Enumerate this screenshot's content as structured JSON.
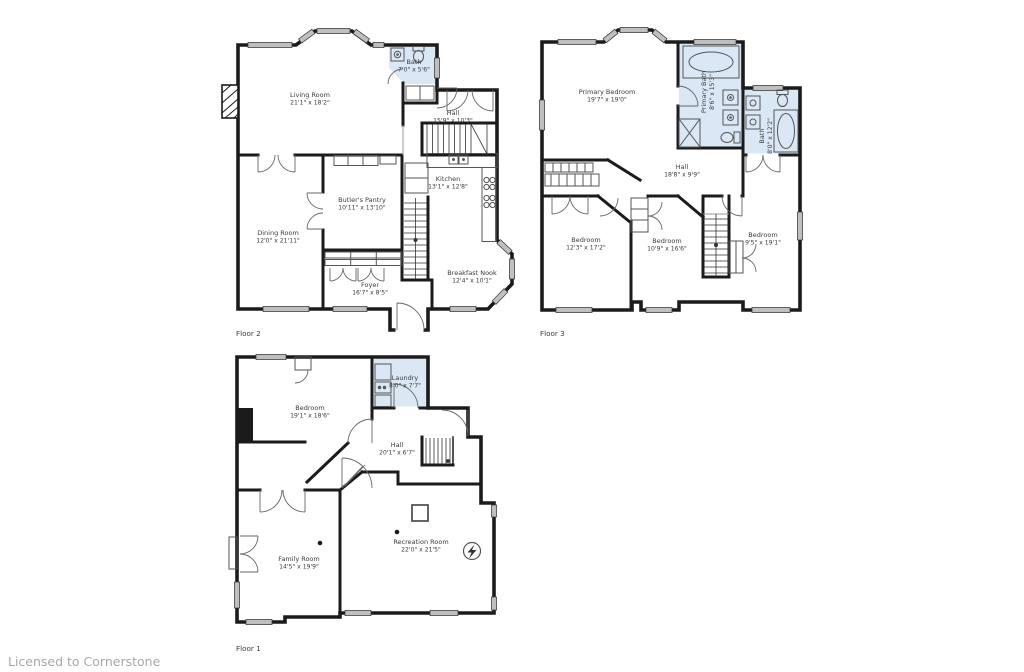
{
  "watermark": "Licensed to Cornerstone",
  "colors": {
    "wall": "#1b1b1b",
    "bath_fill": "#d9e8f4",
    "window_fill": "#bfbfbf",
    "label": "#3b3b3b",
    "watermark": "#a8a8a8"
  },
  "floor2": {
    "label": "Floor 2",
    "rooms": {
      "living": {
        "name": "Living Room",
        "dims": "21'1\" x 18'2\""
      },
      "bath": {
        "name": "Bath",
        "dims": "7'0\" x 5'6\""
      },
      "hall": {
        "name": "Hall",
        "dims": "15'9\" x 10'3\""
      },
      "kitchen": {
        "name": "Kitchen",
        "dims": "13'1\" x 12'8\""
      },
      "pantry": {
        "name": "Butler's Pantry",
        "dims": "10'11\" x 13'10\""
      },
      "dining": {
        "name": "Dining Room",
        "dims": "12'0\" x 21'11\""
      },
      "nook": {
        "name": "Breakfast Nook",
        "dims": "12'4\" x 10'1\""
      },
      "foyer": {
        "name": "Foyer",
        "dims": "16'7\" x 8'5\""
      }
    }
  },
  "floor3": {
    "label": "Floor 3",
    "rooms": {
      "primary": {
        "name": "Primary Bedroom",
        "dims": "19'7\" x 19'0\""
      },
      "primary_bath": {
        "name": "Primary Bath",
        "dims": "8'6\" x 15'3\""
      },
      "bath": {
        "name": "Bath",
        "dims": "8'0\" x 12'2\""
      },
      "hall": {
        "name": "Hall",
        "dims": "18'8\" x 9'9\""
      },
      "bedroom_left": {
        "name": "Bedroom",
        "dims": "12'3\" x 17'2\""
      },
      "bedroom_mid": {
        "name": "Bedroom",
        "dims": "10'9\" x 16'6\""
      },
      "bedroom_right": {
        "name": "Bedroom",
        "dims": "9'5\" x 19'1\""
      }
    }
  },
  "floor1": {
    "label": "Floor 1",
    "rooms": {
      "bedroom": {
        "name": "Bedroom",
        "dims": "19'1\" x 18'6\""
      },
      "laundry": {
        "name": "Laundry",
        "dims": "8'0\" x 7'7\""
      },
      "hall": {
        "name": "Hall",
        "dims": "20'1\" x 6'7\""
      },
      "family": {
        "name": "Family Room",
        "dims": "14'5\" x 19'9\""
      },
      "rec": {
        "name": "Recreation Room",
        "dims": "22'0\" x 21'5\""
      }
    }
  }
}
